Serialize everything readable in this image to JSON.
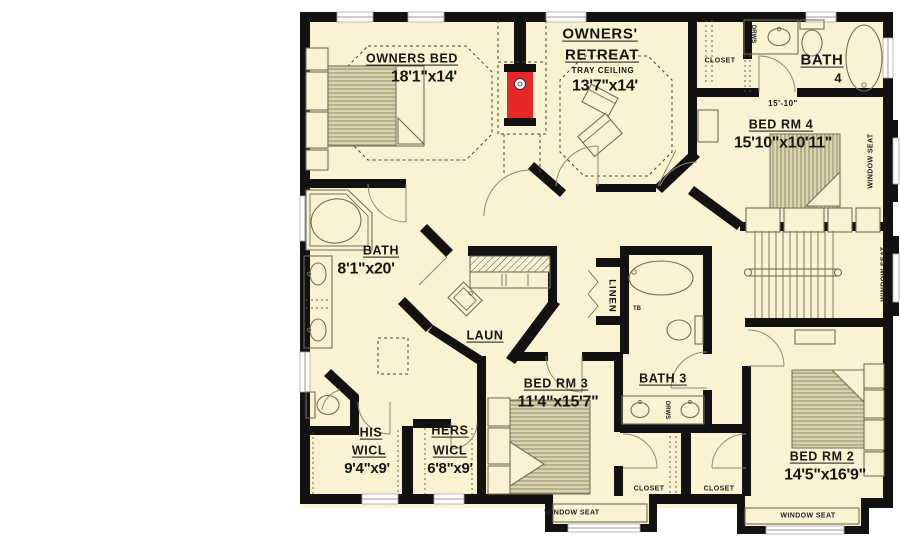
{
  "plan": {
    "title": "Second floor plan",
    "rooms": {
      "owners_bed": {
        "name": "OWNERS BED",
        "dims": "18'1\"x14'"
      },
      "owners_retreat": {
        "line1": "OWNERS'",
        "line2": "RETREAT",
        "note": "TRAY CEILING",
        "dims": "13'7\"x14'"
      },
      "bath4": {
        "name": "BATH",
        "number": "4"
      },
      "bedrm4": {
        "name": "BED RM 4",
        "dims": "15'10\"x10'11\""
      },
      "owners_bath": {
        "name": "BATH",
        "dims": "8'1\"x20'"
      },
      "laundry": {
        "name": "LAUN"
      },
      "linen": {
        "name": "LINEN"
      },
      "bath3": {
        "name": "BATH 3"
      },
      "bedrm3": {
        "name": "BED RM 3",
        "dims": "11'4\"x15'7\""
      },
      "his_wicl": {
        "line1": "HIS",
        "line2": "WICL",
        "dims": "9'4\"x9'"
      },
      "hers_wicl": {
        "line1": "HERS",
        "line2": "WICL",
        "dims": "6'8\"x9'"
      },
      "bedrm2": {
        "name": "BED RM 2",
        "dims": "14'5\"x16'9\""
      }
    },
    "labels": {
      "closet": "CLOSET",
      "window_seat": "WINDOW SEAT",
      "drws": "DRWS",
      "tb": "TB",
      "dim_bedrm4_width": "15'-10\""
    },
    "colors": {
      "floor": "#FAF3D2",
      "wall": "#121212",
      "fireplace": "#E8272B",
      "bed_fill": "#D9D4AB",
      "outline": "#6E6E58"
    }
  }
}
